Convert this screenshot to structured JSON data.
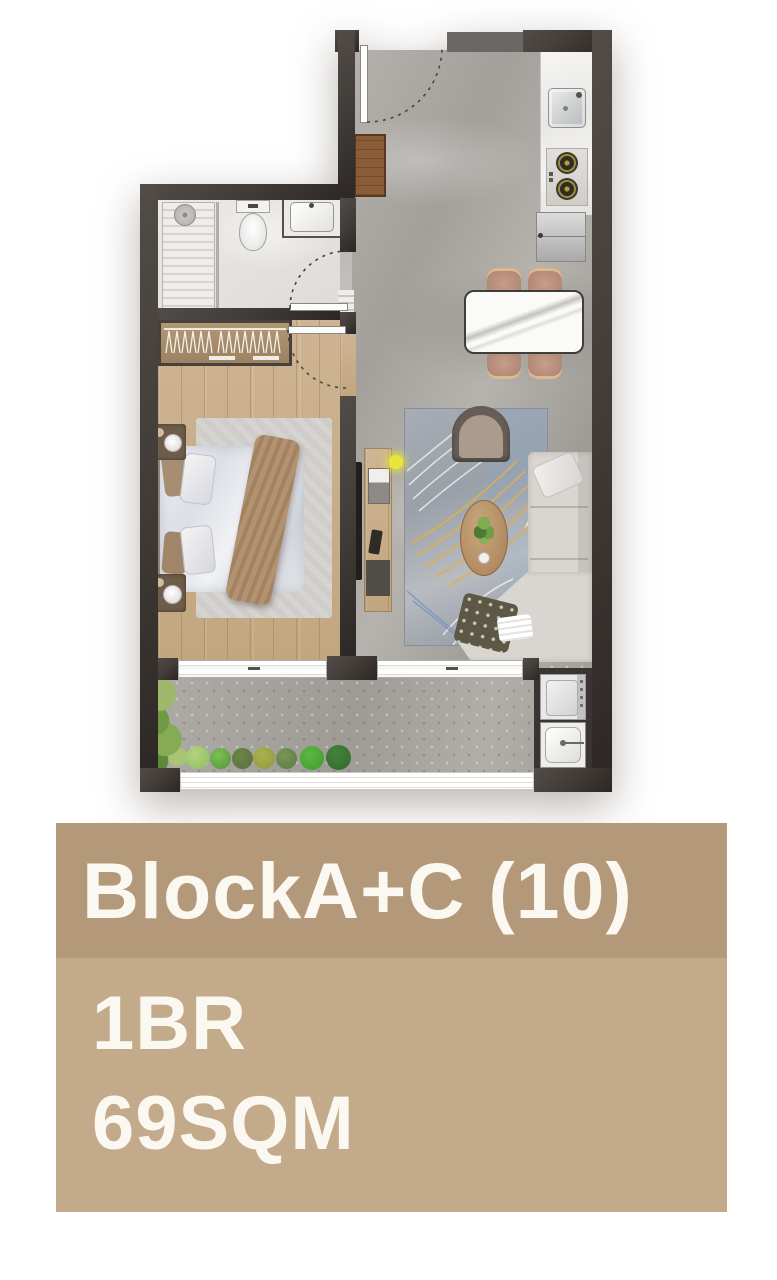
{
  "unit_card": {
    "title": "BlockA+C (10)",
    "bedrooms": "1BR",
    "area": "69SQM"
  },
  "palette": {
    "card_header": "#b3997a",
    "card_body": "#c3aa8b",
    "card_text": "#fbf8f2",
    "wall": "#443e3a",
    "wall_dark": "#2c2724",
    "stone": "#a9a6a1",
    "wood": "#c9ae8c",
    "tile": "#e9e7e4",
    "counter": "#f4f3f0",
    "sofa": "#d9d6d1",
    "chair": "#bf9885",
    "accent_yellow": "#e9e53a",
    "plant_green": "#69a23e"
  }
}
